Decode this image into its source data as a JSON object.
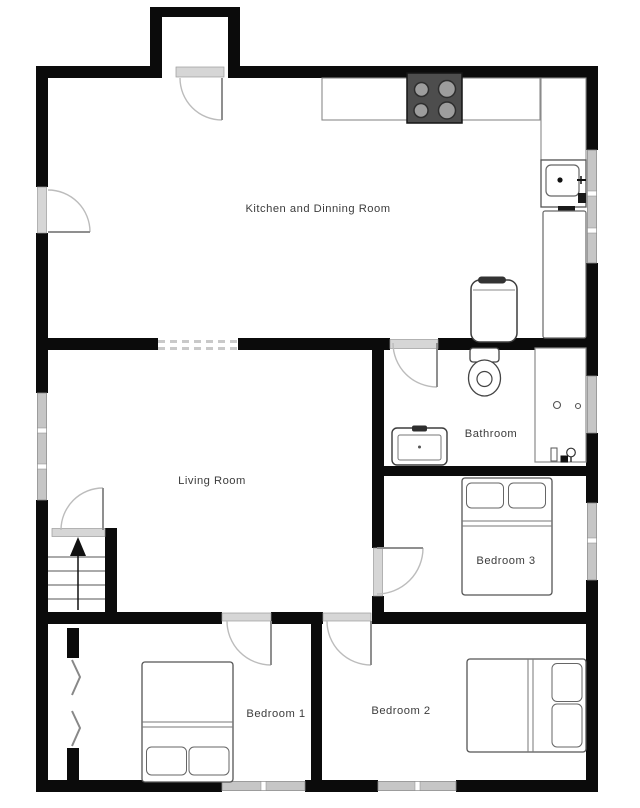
{
  "plan": {
    "type": "residential floor plan",
    "rooms": {
      "kitchen": {
        "label": "Kitchen and Dinning Room"
      },
      "living": {
        "label": "Living Room"
      },
      "bathroom": {
        "label": "Bathroom"
      },
      "bedroom1": {
        "label": "Bedroom 1"
      },
      "bedroom2": {
        "label": "Bedroom 2"
      },
      "bedroom3": {
        "label": "Bedroom 3"
      }
    },
    "stairs": {
      "direction": "up"
    },
    "fixtures": [
      "stove-cooktop-4-burners",
      "kitchen-counter",
      "kitchen-sink",
      "tall-cabinet",
      "water-heater",
      "toilet",
      "washing-machine",
      "bathtub",
      "double-bed-bedroom1",
      "double-bed-bedroom2",
      "double-bed-bedroom3",
      "bifold-closet-doors",
      "staircase-up"
    ],
    "colors": {
      "background": "#ffffff",
      "wall": "#0b0b0b",
      "window": "#c6c6c6",
      "door_threshold": "#d6d6d6",
      "door_arc": "#bcbcbc",
      "stove_body": "#4d4d4d",
      "burner": "#9d9d9d",
      "label_text": "#3c3c3c"
    }
  }
}
